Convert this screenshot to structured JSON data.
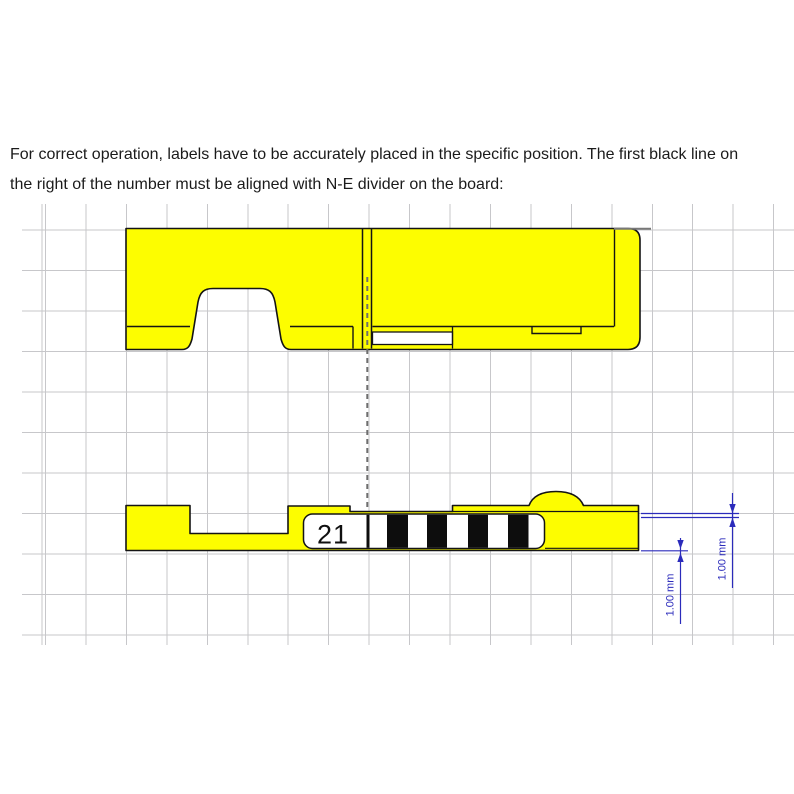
{
  "instructions": {
    "line1": "For correct operation, labels have to be accurately placed in the specific position. The first black line on",
    "line2": "the right of the number must be aligned with N-E divider on the board:"
  },
  "label": {
    "number": "21"
  },
  "dimensions": [
    {
      "label": "1.00 mm"
    },
    {
      "label": "1.00 mm"
    }
  ],
  "colors": {
    "part_yellow": "#fdfd00",
    "grid_line": "#c7c7ca",
    "outline_black": "#141414",
    "stripe_black": "#0d0d0d",
    "dimension_blue": "#2b2bbb",
    "dashed_gray": "#6e6e6e"
  }
}
